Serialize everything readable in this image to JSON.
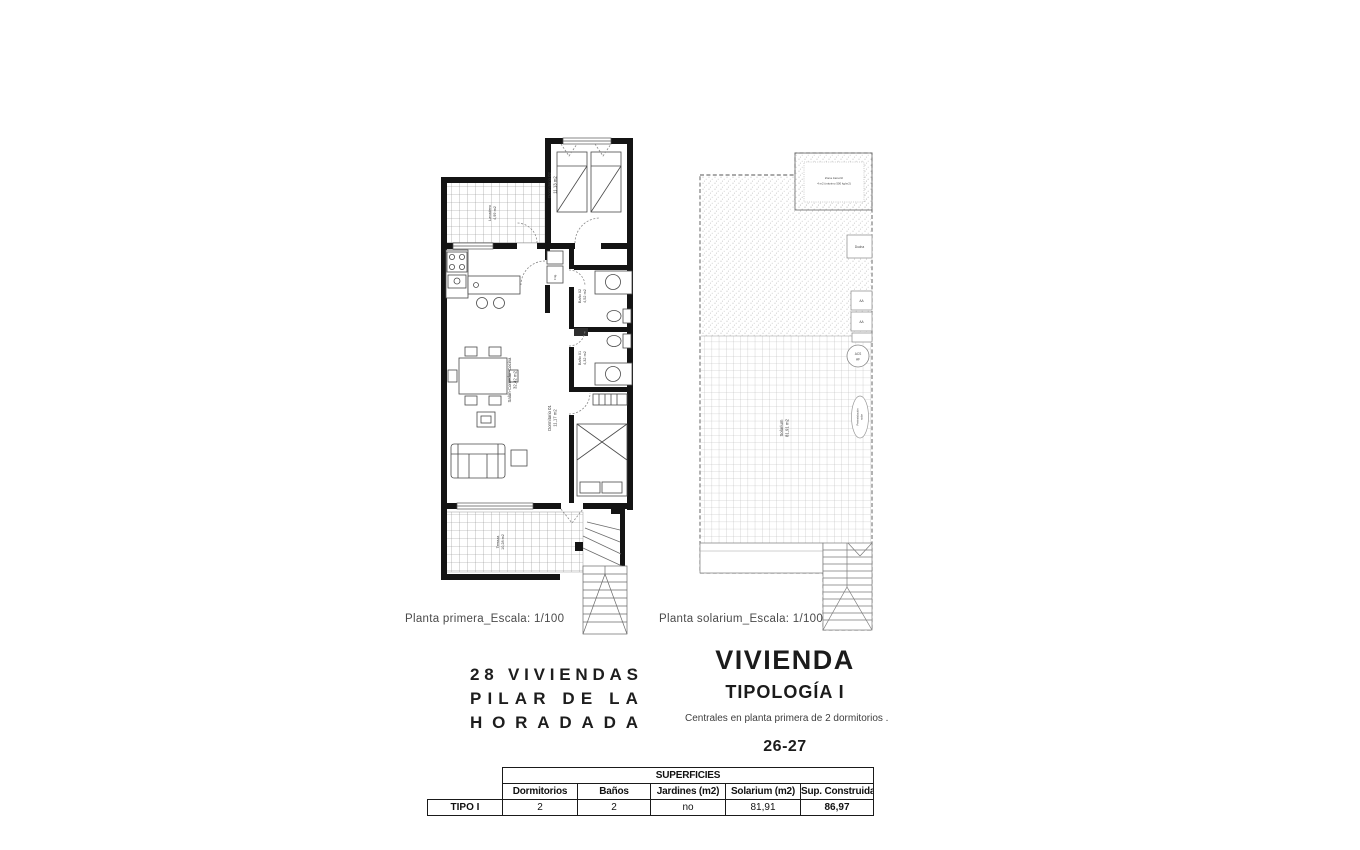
{
  "captions": {
    "first": "Planta primera_Escala: 1/100",
    "solarium": "Planta solarium_Escala: 1/100"
  },
  "project": {
    "line1": "28 VIVIENDAS",
    "line2": "PILAR DE LA",
    "line3": "HORADADA"
  },
  "typology": {
    "title": "VIVIENDA",
    "subtitle": "TIPOLOGÍA I",
    "description": "Centrales en planta primera de 2 dormitorios .",
    "units": "26-27"
  },
  "first_floor": {
    "rooms": {
      "lavadero": {
        "name": "Lavadero",
        "area": "4,99 m2"
      },
      "dormitorio02": {
        "name": "Dormitorio 02",
        "area": "11,13 m2"
      },
      "bano02": {
        "name": "Baño 02",
        "area": "4,52 m2"
      },
      "bano01": {
        "name": "Baño 01",
        "area": "4,32 m2"
      },
      "dormitorio01": {
        "name": "Dormitorio 01",
        "area": "11,17 m2"
      },
      "salon": {
        "name": "Salón-Comedor-Cocina",
        "area": "32,42 m2"
      },
      "terraza": {
        "name": "Terraza",
        "area": "10,28 m2"
      },
      "frigo": "Frig."
    }
  },
  "solarium_plan": {
    "labels": {
      "jacuzzi_line1": "Zona Jacuzzi",
      "jacuzzi_line2": "4 m2 (máximo 500 kg/m2)",
      "ducha": "Ducha",
      "aa1": "AA",
      "aa2": "AA",
      "acs": "ACS",
      "af": "AF",
      "preinst_line1": "Preinstalación",
      "preinst_line2": "solar",
      "solarium": {
        "name": "Solarium",
        "area": "81,91 m2"
      }
    }
  },
  "table": {
    "title": "SUPERFICIES",
    "row_label": "TIPO I",
    "columns": [
      "Dormitorios",
      "Baños",
      "Jardines (m2)",
      "Solarium (m2)",
      "Sup. Construida"
    ],
    "values": [
      "2",
      "2",
      "no",
      "81,91",
      "86,97"
    ]
  }
}
